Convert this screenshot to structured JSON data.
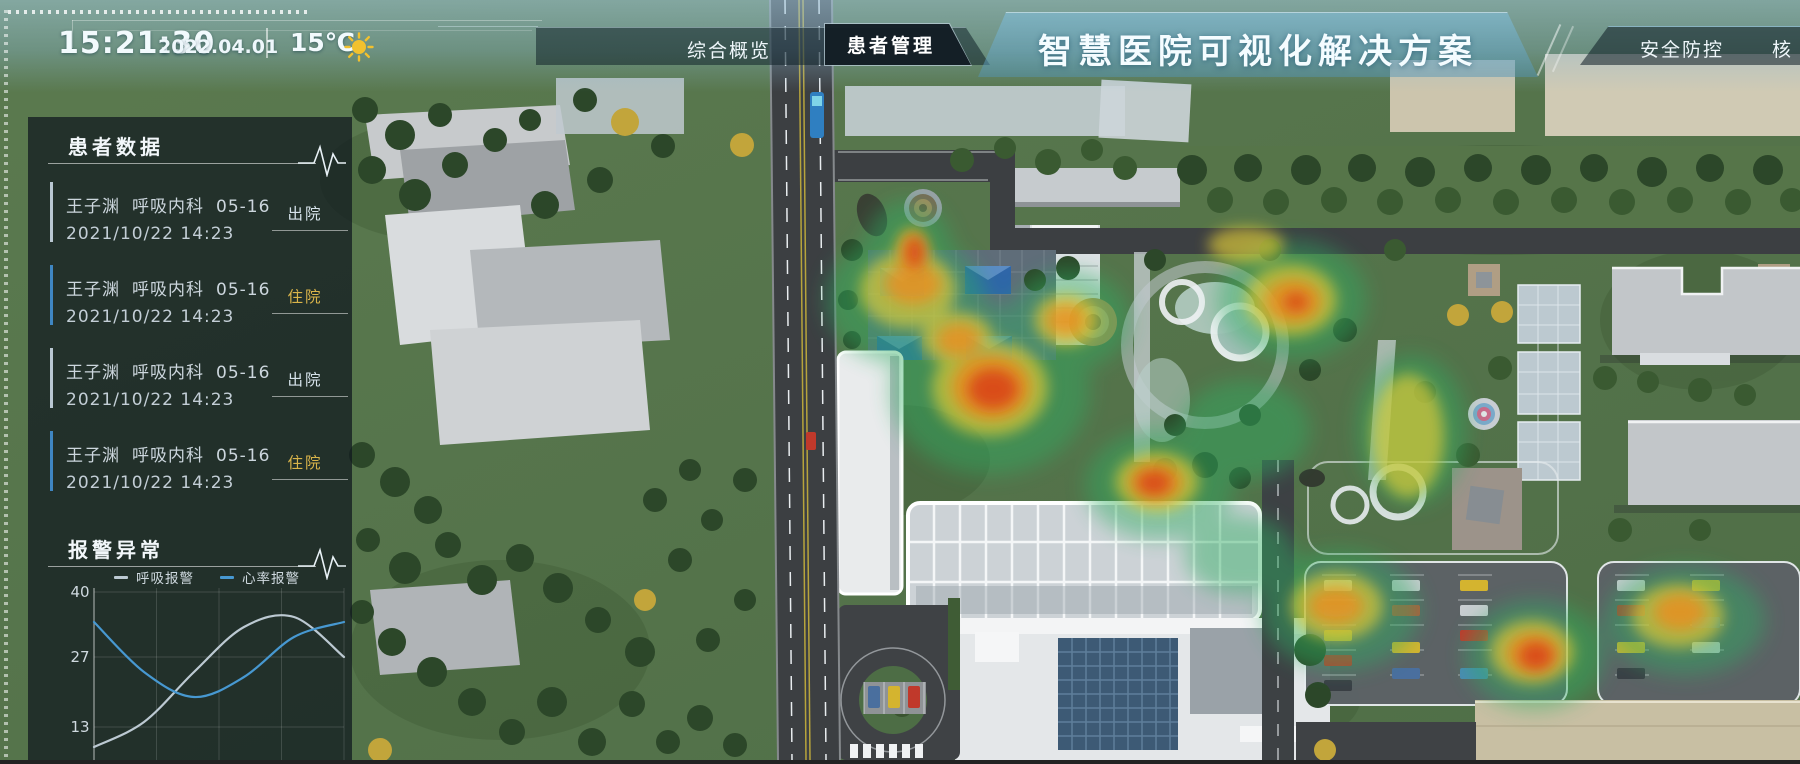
{
  "app": {
    "title": "智慧医院可视化解决方案"
  },
  "topbar": {
    "time": "15:21:30",
    "date": "2022.04.01",
    "temperature": "15℃",
    "weather": "sunny"
  },
  "nav": {
    "left_tabs": [
      {
        "label": "综合概览",
        "active": false
      },
      {
        "label": "患者管理",
        "active": true
      }
    ],
    "right_tabs": [
      {
        "label": "安全防控",
        "active": false
      },
      {
        "label": "核",
        "active": false
      }
    ]
  },
  "patient_panel": {
    "title": "患者数据",
    "items": [
      {
        "name": "王子渊",
        "department": "呼吸内科",
        "bed": "05-16",
        "datetime": "2021/10/22 14:23",
        "status": "出院",
        "variant": "out"
      },
      {
        "name": "王子渊",
        "department": "呼吸内科",
        "bed": "05-16",
        "datetime": "2021/10/22 14:23",
        "status": "住院",
        "variant": "in"
      },
      {
        "name": "王子渊",
        "department": "呼吸内科",
        "bed": "05-16",
        "datetime": "2021/10/22 14:23",
        "status": "出院",
        "variant": "out"
      },
      {
        "name": "王子渊",
        "department": "呼吸内科",
        "bed": "05-16",
        "datetime": "2021/10/22 14:23",
        "status": "住院",
        "variant": "in"
      }
    ]
  },
  "alarm_panel": {
    "title": "报警异常"
  },
  "chart_data": {
    "type": "line",
    "title": "报警异常",
    "x": [
      0,
      1,
      2,
      3,
      4,
      5
    ],
    "x_tick_labels_visible": false,
    "series": [
      {
        "name": "呼吸报警",
        "color": "#bcc9d2",
        "values": [
          9,
          14,
          24,
          33,
          35,
          27
        ]
      },
      {
        "name": "心率报警",
        "color": "#4798d1",
        "values": [
          34,
          24,
          19,
          23,
          31,
          34
        ]
      }
    ],
    "ylim": [
      0,
      40
    ],
    "yticks": [
      13,
      27,
      40
    ],
    "grid": true,
    "legend_position": "top"
  },
  "colors": {
    "accent_cyan": "#9fd8e8",
    "badge_inpatient": "#d9b44a",
    "badge_discharged": "#d5e2ea",
    "bar_inpatient": "#3f86c2",
    "bar_discharged": "#b9c7d2",
    "panel_bg": "rgba(16,24,31,0.74)",
    "heat_red": "#d93a18",
    "heat_orange": "#ee8b1e",
    "heat_yellow": "#e4cf38",
    "heat_green": "#2fae62"
  }
}
